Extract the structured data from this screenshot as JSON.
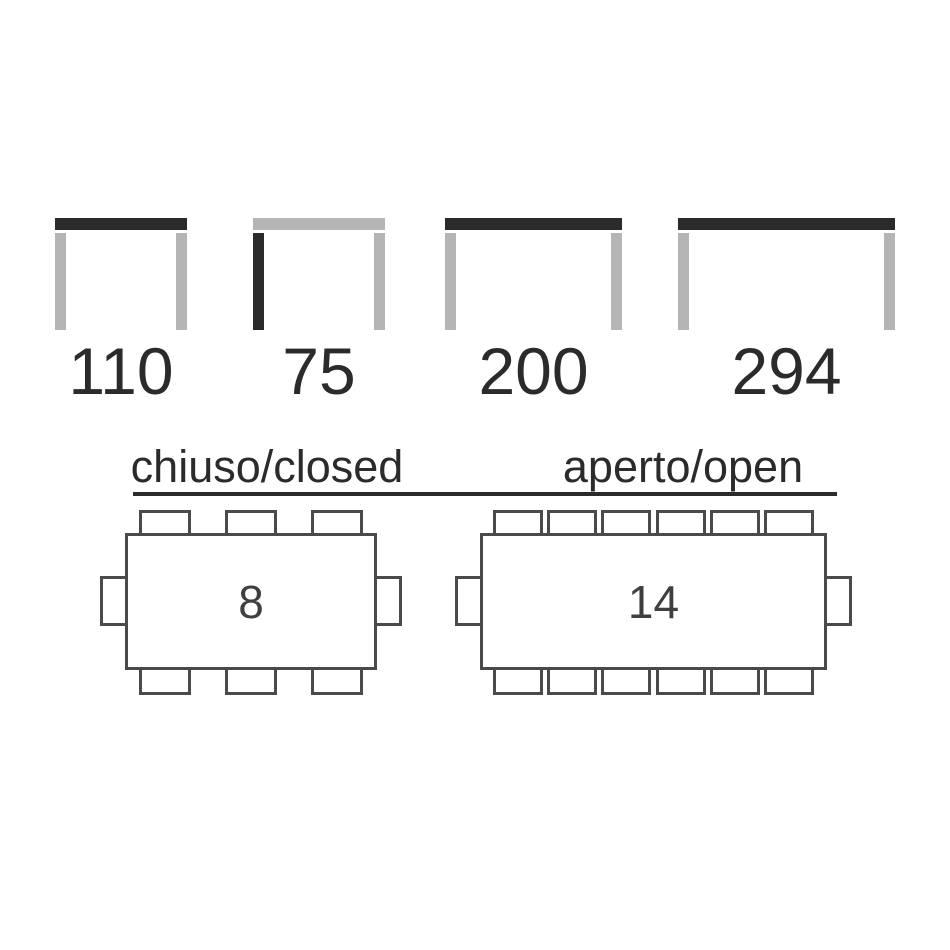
{
  "colors": {
    "page_background": "#ffffff",
    "highlight_dark": "#2b2b2b",
    "neutral_gray": "#b5b5b5",
    "plan_outline": "#4a4a4a",
    "seat_number": "#3f3f3f",
    "label_text": "#2b2b2b"
  },
  "elevation_diagrams": [
    {
      "value": "110",
      "highlighted_part": "tabletop"
    },
    {
      "value": "75",
      "highlighted_part": "left-leg"
    },
    {
      "value": "200",
      "highlighted_part": "tabletop"
    },
    {
      "value": "294",
      "highlighted_part": "tabletop"
    }
  ],
  "plan_section": {
    "closed": {
      "title": "chiuso/closed",
      "seats": "8",
      "chairs": {
        "top": 3,
        "bottom": 3,
        "left": 1,
        "right": 1
      }
    },
    "open": {
      "title": "aperto/open",
      "seats": "14",
      "chairs": {
        "top": 6,
        "bottom": 6,
        "left": 1,
        "right": 1
      }
    }
  }
}
